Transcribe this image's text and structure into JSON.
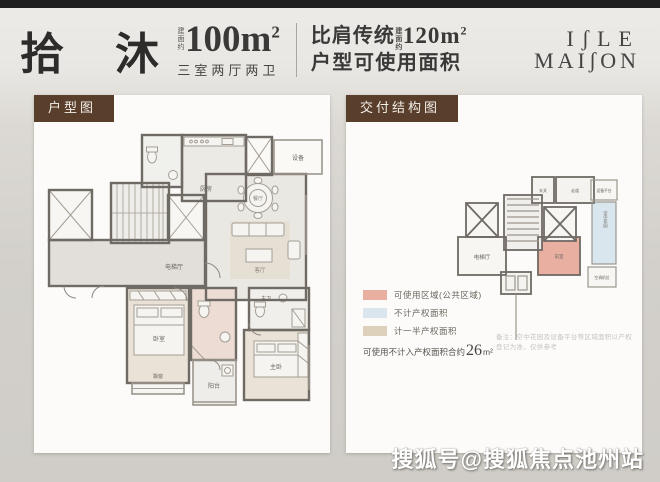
{
  "header": {
    "title": "拾 沐",
    "area": {
      "prefix": "建面约",
      "value": "100m",
      "sup": "2",
      "subtitle": "三室两厅两卫"
    },
    "compare": {
      "line1_pre": "比肩传统",
      "prefix": "建面约",
      "value": "120m",
      "sup": "2",
      "line2": "户型可使用面积"
    },
    "logo": {
      "line1": "IʃLE",
      "line2": "MAIʃON"
    }
  },
  "left_panel": {
    "tab": "户型图",
    "rooms": {
      "kitchen": "厨房",
      "equipment": "设备",
      "elevator_hall": "电梯厅",
      "dining": "餐厅",
      "living": "客厅",
      "bedroom": "卧室",
      "bay_window": "飘窗",
      "balcony": "阳台",
      "master_bedroom": "主卧",
      "master_bath": "主卫"
    }
  },
  "right_panel": {
    "tab": "交付结构图",
    "diagram": {
      "elevator_hall": "电梯厅",
      "vestibule": "前室",
      "hallway": "走道",
      "foyer": "玄关",
      "equipment_platform": "设备平台",
      "sky_garden": "空中花园",
      "ac_platform": "空调机位"
    },
    "legend": {
      "items": [
        {
          "color": "#e9b0a2",
          "label": "可使用区域(公共区域)"
        },
        {
          "color": "#d9e6ee",
          "label": "不计产权面积"
        },
        {
          "color": "#ddd1bc",
          "label": "计一半产权面积"
        }
      ],
      "summary_pre": "可使用不计入产权面积合约",
      "summary_value": "26",
      "summary_unit": "m²"
    },
    "note": "备注：空中花园及设备平台等区域面积以产权登记为准，仅供参考"
  },
  "watermark": "搜狐号@搜狐焦点池州站",
  "colors": {
    "tab_brown": "#5a3e2c",
    "wall": "#6f6a64",
    "page_bg": "#d3d0cb",
    "panel_bg": "#fcfbf9",
    "top_bar": "#1f1f1f"
  }
}
